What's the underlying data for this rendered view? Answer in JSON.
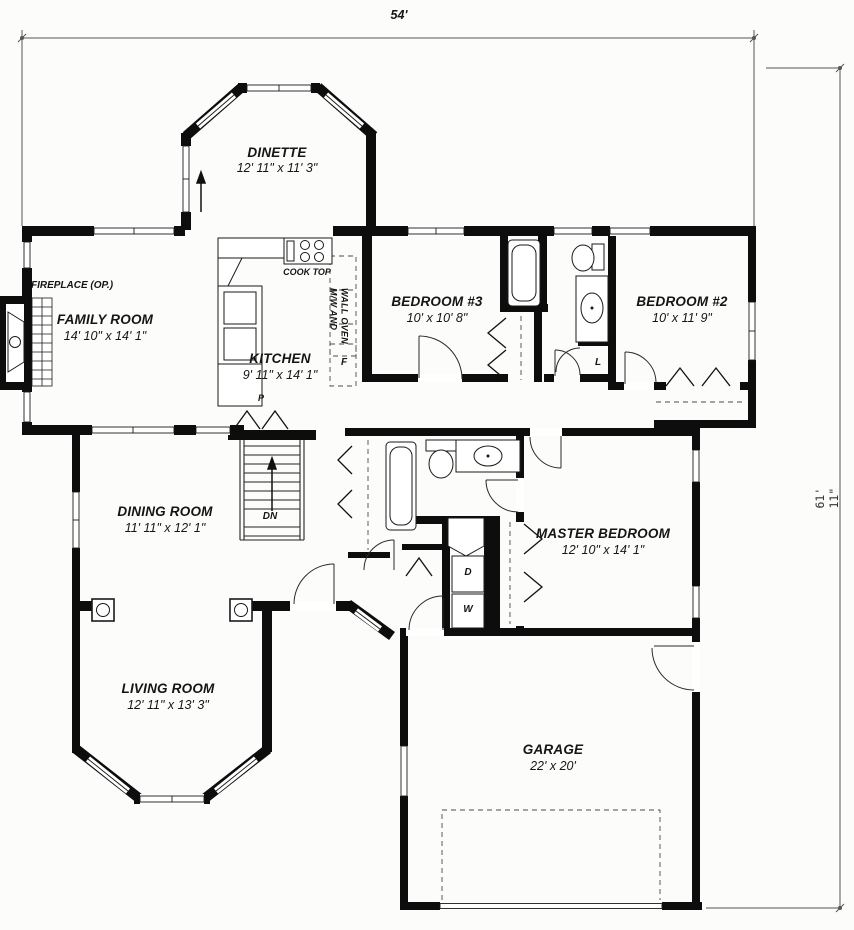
{
  "sheet": {
    "type": "single-story house floor plan"
  },
  "dimensions": {
    "overall_width": "54'",
    "overall_height": "61' 11\""
  },
  "rooms": [
    {
      "name": "DINETTE",
      "size": "12' 11\" x 11' 3\""
    },
    {
      "name": "FAMILY ROOM",
      "size": "14' 10\" x 14' 1\""
    },
    {
      "name": "KITCHEN",
      "size": "9' 11\" x 14' 1\""
    },
    {
      "name": "BEDROOM #3",
      "size": "10' x 10' 8\""
    },
    {
      "name": "BEDROOM #2",
      "size": "10' x 11' 9\""
    },
    {
      "name": "DINING ROOM",
      "size": "11' 11\" x 12' 1\""
    },
    {
      "name": "MASTER BEDROOM",
      "size": "12' 10\" x 14' 1\""
    },
    {
      "name": "LIVING ROOM",
      "size": "12' 11\" x 13' 3\""
    },
    {
      "name": "GARAGE",
      "size": "22' x 20'"
    }
  ],
  "labels": {
    "fireplace": "FIREPLACE (OP.)",
    "cook_top": "COOK TOP",
    "wall_oven_line1": "M/W AND",
    "wall_oven_line2": "WALL OVEN",
    "refrigerator": "F",
    "linen": "L",
    "pantry": "P",
    "stairs_down": "DN",
    "dryer": "D",
    "washer": "W"
  },
  "colors": {
    "wall": "#0d0d0d",
    "line": "#1a1a1a",
    "paper": "#fcfcfa",
    "dim": "#555555",
    "arc": "#2a2a2a"
  }
}
